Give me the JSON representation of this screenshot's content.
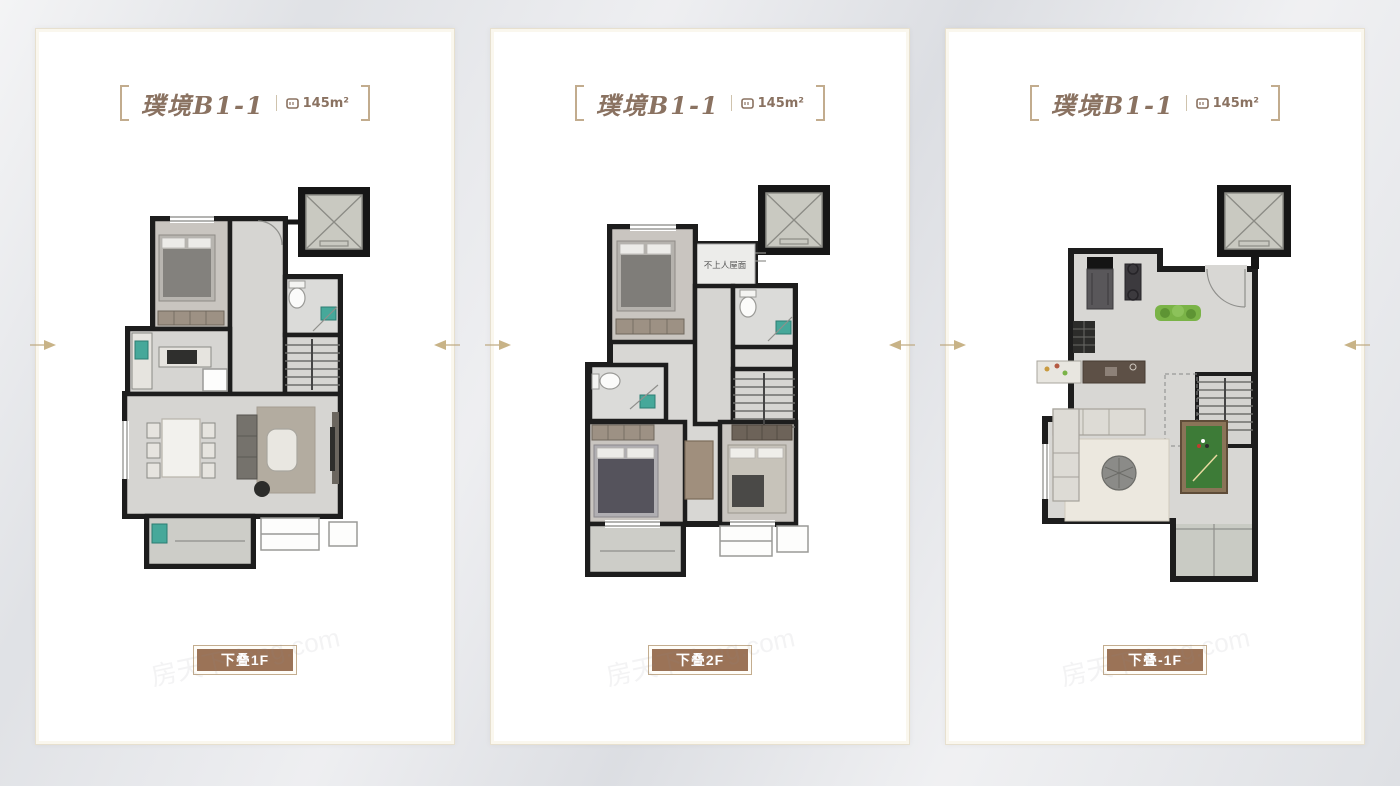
{
  "cards": [
    {
      "title": "璞境B1-1",
      "area_value": "145m²",
      "floor_label": "下叠1F"
    },
    {
      "title": "璞境B1-1",
      "area_value": "145m²",
      "floor_label": "下叠2F",
      "roof_note": "不上人屋面"
    },
    {
      "title": "璞境B1-1",
      "area_value": "145m²",
      "floor_label": "下叠-1F"
    }
  ],
  "watermark": "房天下 fang.com",
  "colors": {
    "accent_brown": "#9b7357",
    "title_text": "#8a7261",
    "bracket": "#c2ac8e",
    "wall_black": "#1d1d1d",
    "fixture_teal": "#46a89a",
    "plant_green": "#7ab347",
    "billiard_green": "#3d7b37",
    "card_bg": "#ffffff",
    "page_bg": "#e6e7ea"
  }
}
